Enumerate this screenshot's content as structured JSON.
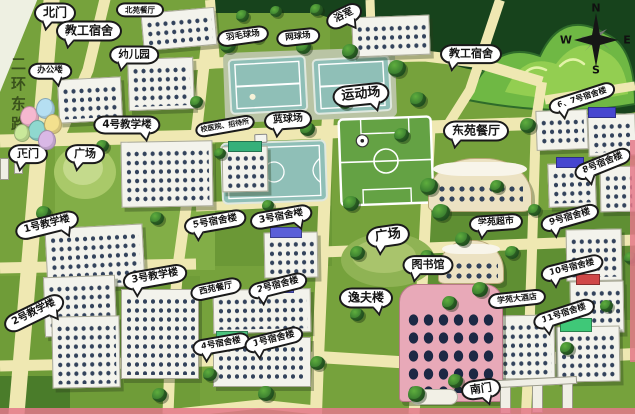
{
  "labels": {
    "north_gate": "北门",
    "north_canteen": "北苑餐厅",
    "staff_dorm_west": "教工宿舍",
    "kindergarten": "幼儿园",
    "office_building": "办公楼",
    "badminton_court": "羽毛球场",
    "tennis_court": "网球场",
    "bath_house": "浴室",
    "staff_dorm_east": "教工宿舍",
    "sports_field": "运动场",
    "basketball_court": "蓝球场",
    "clinic_guesthouse": "校医院、招待所",
    "dorm_6_7": "6、7号宿舍楼",
    "teaching_4": "4号教学楼",
    "main_gate": "正门",
    "plaza_west": "广场",
    "east_canteen": "东苑餐厅",
    "dorm_8": "8号宿舍楼",
    "teaching_1": "1号教学楼",
    "dorm_5": "5号宿舍楼",
    "dorm_3": "3号宿舍楼",
    "plaza_center": "广场",
    "dorm_9": "9号宿舍楼",
    "campus_market": "学苑超市",
    "library": "图书馆",
    "dorm_10": "10号宿舍楼",
    "teaching_3": "3号教学楼",
    "teaching_2": "2号教学楼",
    "west_canteen": "西苑餐厅",
    "dorm_2": "2号宿舍楼",
    "yifu_building": "逸夫楼",
    "dorm_4": "4号宿舍楼",
    "dorm_1": "1号宿舍楼",
    "hotel": "学苑大酒店",
    "dorm_11": "11号宿舍楼",
    "south_gate": "南门",
    "road_name": "二环东路"
  },
  "compass": {
    "north": "N",
    "south": "S",
    "east": "E",
    "west": "W"
  },
  "colors": {
    "grass": "#76a23c",
    "road": "#efe8b2",
    "court": "#8fbfb7",
    "field": "#64a244",
    "forest": "#17431c",
    "building": "#f3f3ec",
    "window": "#33435c",
    "library": "#e8a9b8",
    "plaza": "#a9c969",
    "strip": "#e4788a"
  }
}
